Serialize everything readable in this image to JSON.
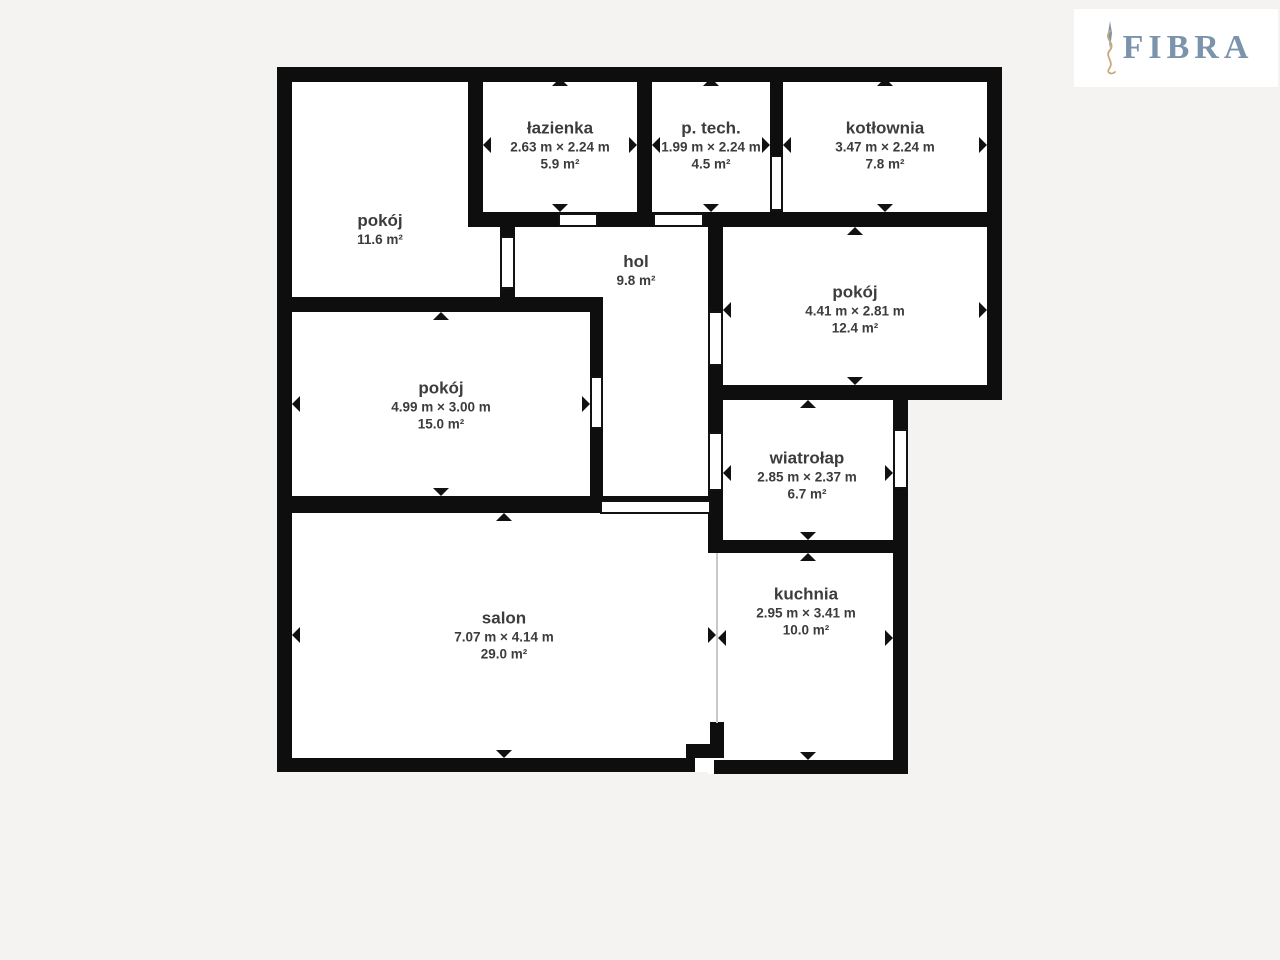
{
  "page": {
    "background_color": "#f4f3f1",
    "wall_color": "#0e0e0e",
    "label_color": "#3c3c3c"
  },
  "logo": {
    "text": "FIBRA",
    "text_color": "#7c94ab",
    "flourish_color": "#c9a87c",
    "icon": "flourish-icon"
  },
  "rooms": [
    {
      "name": "pokój",
      "area": "11.6 m²"
    },
    {
      "name": "łazienka",
      "dimensions": "2.63 m × 2.24 m",
      "area": "5.9 m²"
    },
    {
      "name": "p. tech.",
      "dimensions": "1.99 m × 2.24 m",
      "area": "4.5 m²"
    },
    {
      "name": "kotłownia",
      "dimensions": "3.47 m × 2.24 m",
      "area": "7.8 m²"
    },
    {
      "name": "hol",
      "area": "9.8 m²"
    },
    {
      "name": "pokój",
      "dimensions": "4.41 m × 2.81 m",
      "area": "12.4 m²"
    },
    {
      "name": "pokój",
      "dimensions": "4.99 m × 3.00 m",
      "area": "15.0 m²"
    },
    {
      "name": "wiatrołap",
      "dimensions": "2.85 m × 2.37 m",
      "area": "6.7 m²"
    },
    {
      "name": "salon",
      "dimensions": "7.07 m × 4.14 m",
      "area": "29.0 m²"
    },
    {
      "name": "kuchnia",
      "dimensions": "2.95 m × 3.41 m",
      "area": "10.0 m²"
    }
  ]
}
